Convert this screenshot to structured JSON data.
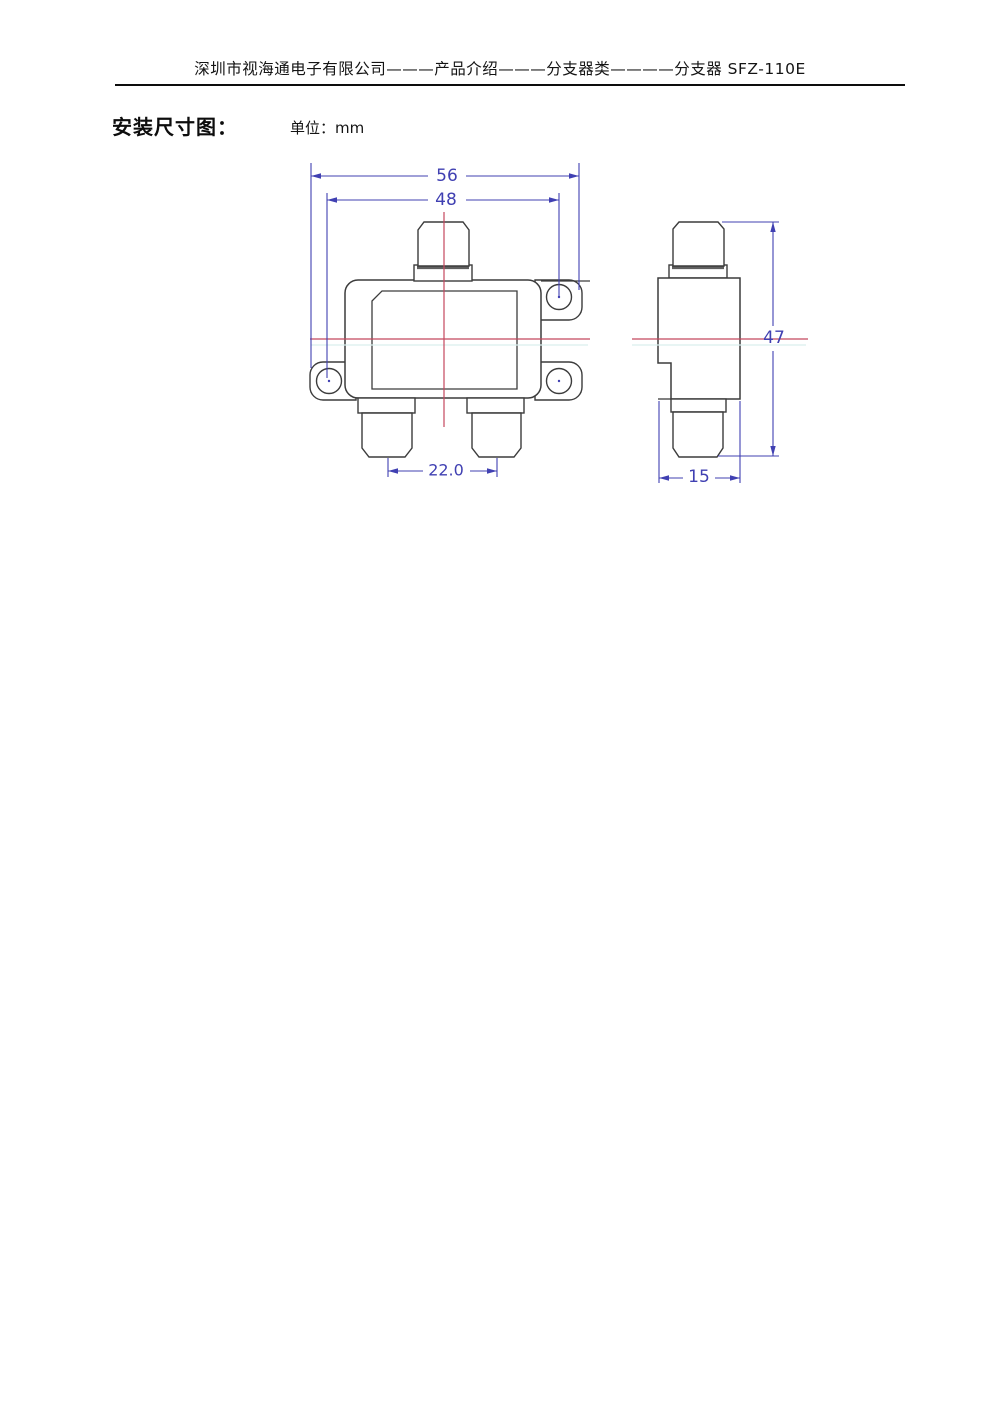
{
  "header": {
    "title": "深圳市视海通电子有限公司———产品介绍———分支器类————分支器 SFZ-110E"
  },
  "section": {
    "title": "安装尺寸图：",
    "unit_label": "单位：mm"
  },
  "drawing": {
    "unit": "mm",
    "product_model": "SFZ-110E",
    "front_view": {
      "dimensions": {
        "overall_width": "56",
        "mounting_hole_spacing": "48",
        "output_port_spacing": "22.0"
      }
    },
    "side_view": {
      "dimensions": {
        "overall_height": "47",
        "body_depth": "15"
      }
    },
    "colors": {
      "outline": "#3c3c3c",
      "dimension_blue": "#4040b2",
      "centerline_red": "#c4485e",
      "auxiliary_cyan": "#d9efee"
    }
  }
}
